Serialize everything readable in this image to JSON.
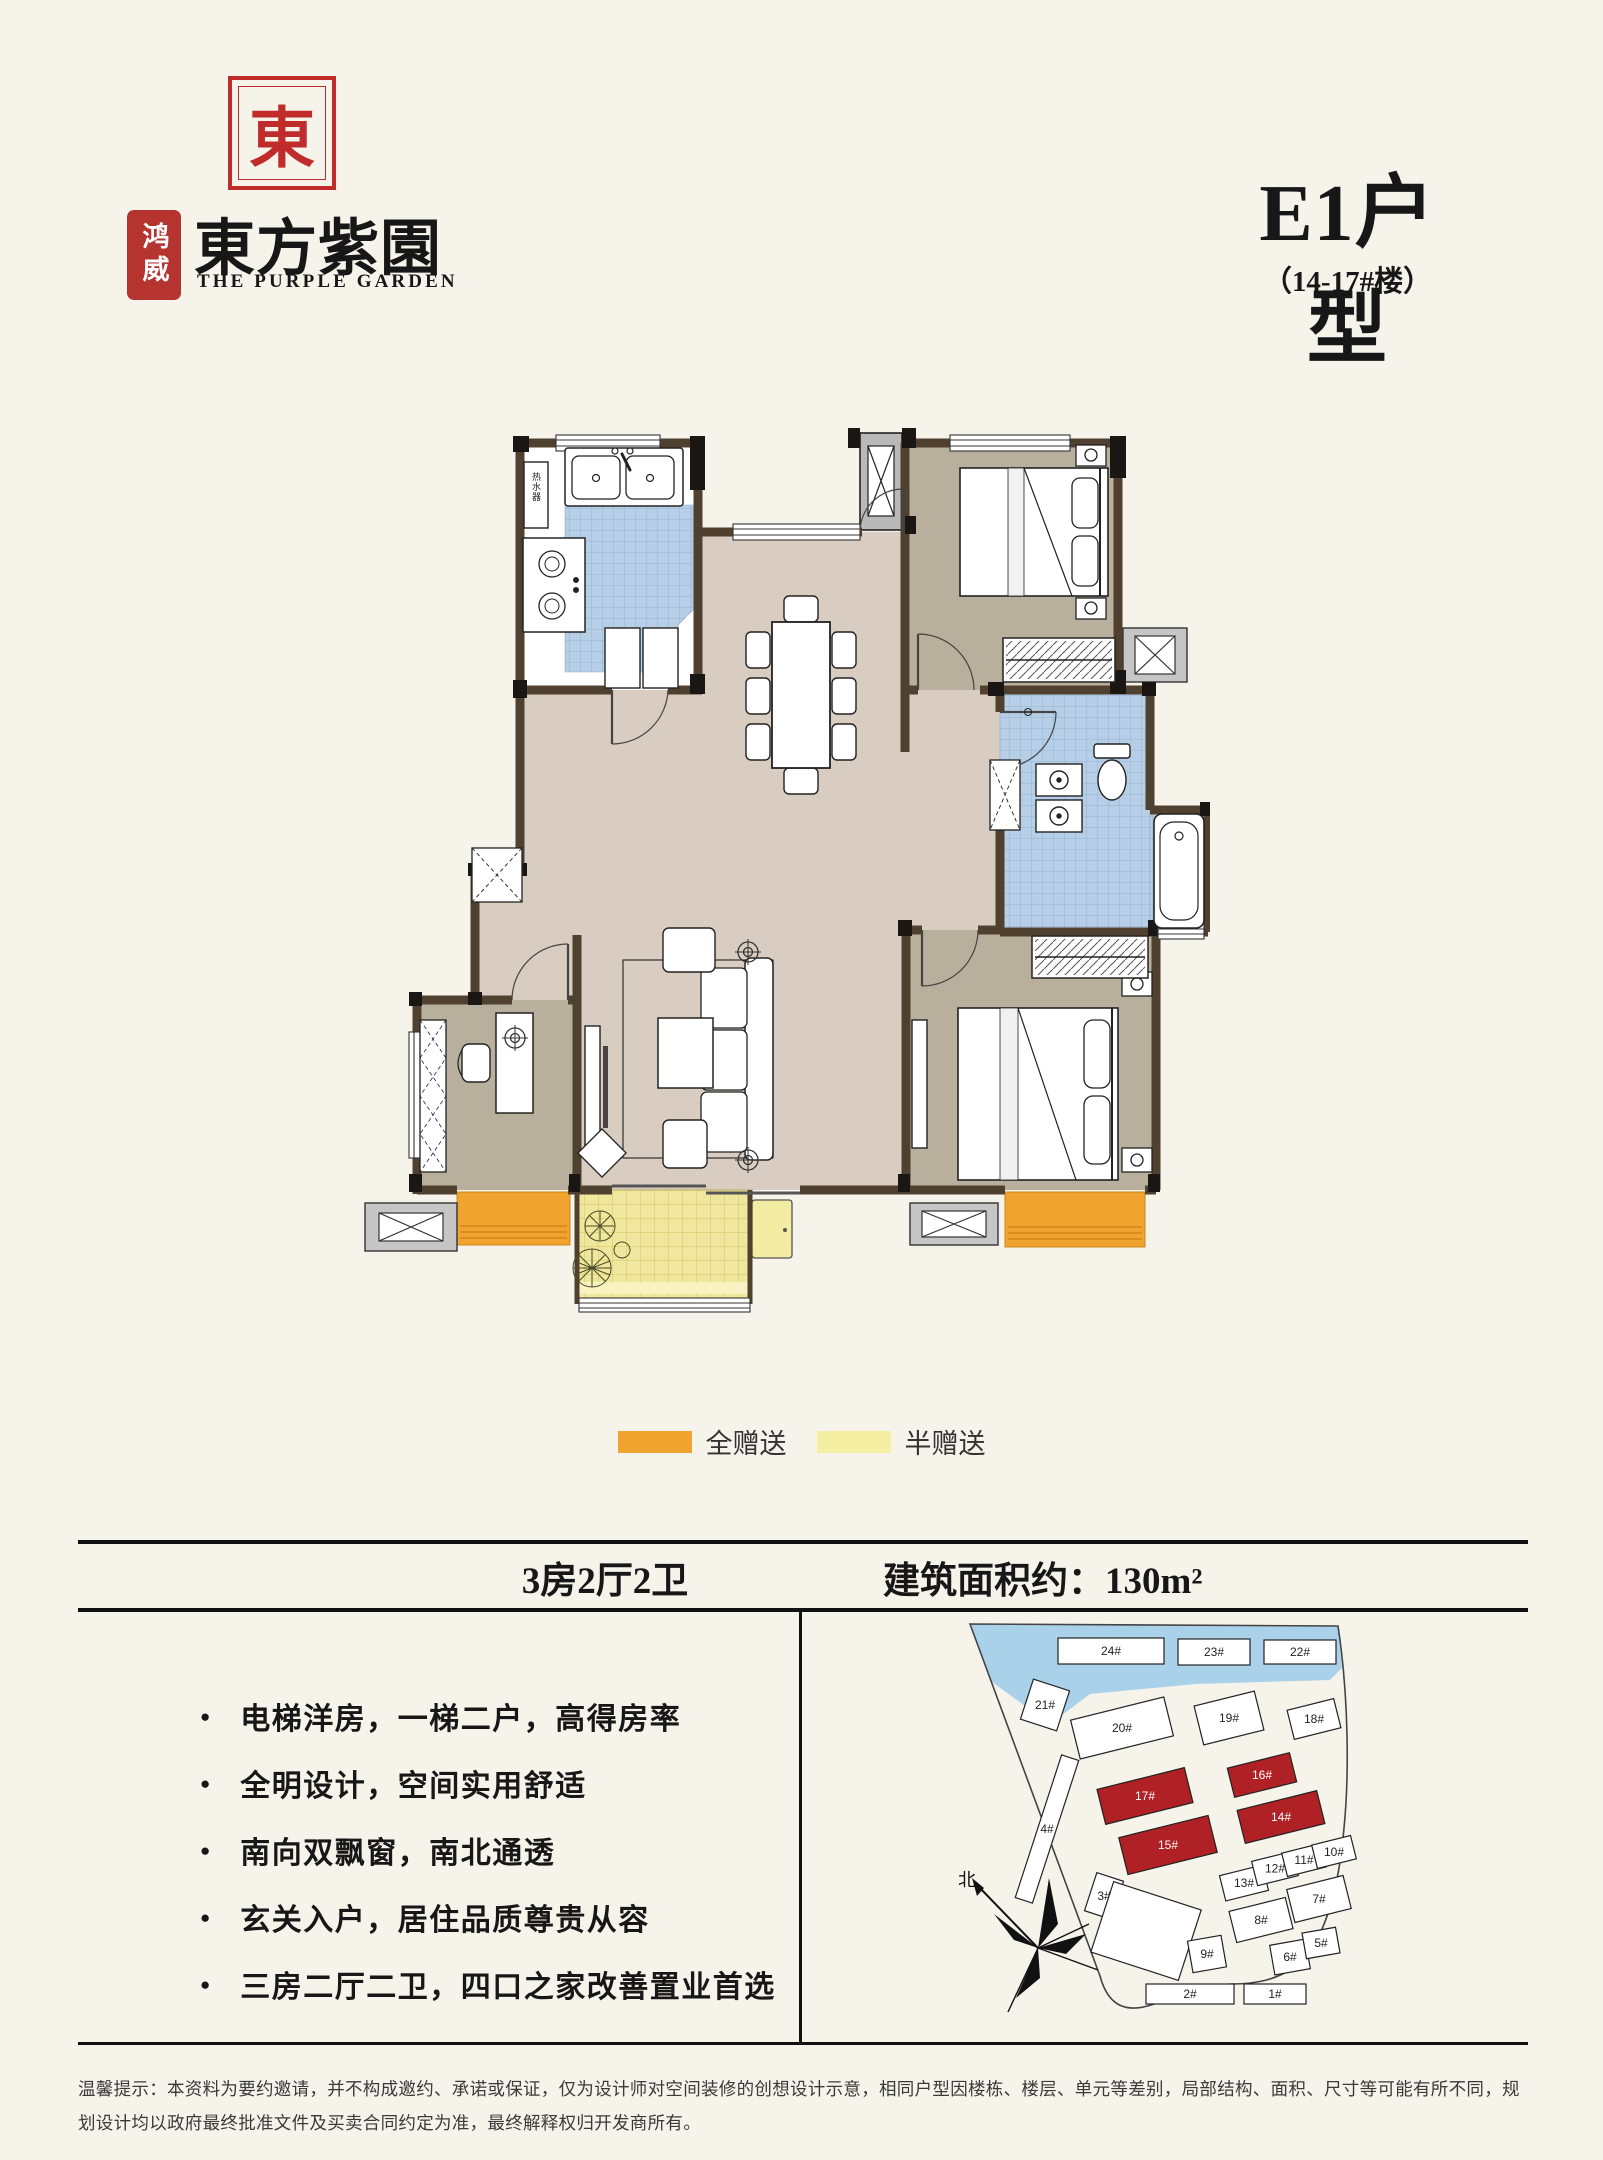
{
  "brand": {
    "seal_glyph": "東",
    "sub_seal": "鸿威",
    "name_cn": "東方紫園",
    "name_en": "THE PURPLE GARDEN"
  },
  "header": {
    "unit_title": "E1户型",
    "unit_subtitle": "（14-17#楼）"
  },
  "floor_plan": {
    "water_heater_label": "热水器"
  },
  "legend": {
    "items": [
      {
        "label": "全赠送",
        "color": "#f0a32e"
      },
      {
        "label": "半赠送",
        "color": "#f5efa4"
      }
    ]
  },
  "info_bar": {
    "layout": "3房2厅2卫",
    "area": "建筑面积约：130m²"
  },
  "features": [
    "电梯洋房，一梯二户，高得房率",
    "全明设计，空间实用舒适",
    "南向双飘窗，南北通透",
    "玄关入户，居住品质尊贵从容",
    "三房二厅二卫，四口之家改善置业首选"
  ],
  "site_map": {
    "north_label": "北",
    "highlight_color": "#b02125",
    "water_color": "#a9d1ea",
    "buildings": [
      {
        "label": "24#",
        "x": 108,
        "y": 20,
        "w": 106,
        "h": 26,
        "r": 0
      },
      {
        "label": "23#",
        "x": 228,
        "y": 21,
        "w": 72,
        "h": 26,
        "r": 0
      },
      {
        "label": "22#",
        "x": 314,
        "y": 22,
        "w": 72,
        "h": 24,
        "r": 0
      },
      {
        "label": "21#",
        "x": 76,
        "y": 66,
        "w": 38,
        "h": 42,
        "r": 18
      },
      {
        "label": "20#",
        "x": 124,
        "y": 90,
        "w": 96,
        "h": 40,
        "r": -14
      },
      {
        "label": "19#",
        "x": 248,
        "y": 80,
        "w": 62,
        "h": 40,
        "r": -14
      },
      {
        "label": "18#",
        "x": 340,
        "y": 86,
        "w": 48,
        "h": 30,
        "r": -14
      },
      {
        "label": "4#",
        "x": 88,
        "y": 136,
        "w": 18,
        "h": 150,
        "r": 18
      },
      {
        "label": "17#",
        "x": 150,
        "y": 160,
        "w": 90,
        "h": 36,
        "r": -14,
        "hl": true
      },
      {
        "label": "16#",
        "x": 280,
        "y": 142,
        "w": 64,
        "h": 30,
        "r": -14,
        "hl": true
      },
      {
        "label": "15#",
        "x": 172,
        "y": 208,
        "w": 92,
        "h": 38,
        "r": -14,
        "hl": true
      },
      {
        "label": "14#",
        "x": 290,
        "y": 182,
        "w": 82,
        "h": 34,
        "r": -14,
        "hl": true
      },
      {
        "label": "3#",
        "x": 140,
        "y": 258,
        "w": 28,
        "h": 40,
        "r": 18
      },
      {
        "label": "",
        "x": 150,
        "y": 276,
        "w": 92,
        "h": 74,
        "r": 18
      },
      {
        "label": "13#",
        "x": 272,
        "y": 252,
        "w": 44,
        "h": 26,
        "r": -14
      },
      {
        "label": "12#",
        "x": 304,
        "y": 238,
        "w": 42,
        "h": 25,
        "r": -14
      },
      {
        "label": "11#",
        "x": 334,
        "y": 230,
        "w": 40,
        "h": 24,
        "r": -14
      },
      {
        "label": "10#",
        "x": 364,
        "y": 222,
        "w": 40,
        "h": 24,
        "r": -14
      },
      {
        "label": "8#",
        "x": 282,
        "y": 286,
        "w": 58,
        "h": 32,
        "r": -14
      },
      {
        "label": "7#",
        "x": 340,
        "y": 264,
        "w": 58,
        "h": 34,
        "r": -14
      },
      {
        "label": "9#",
        "x": 240,
        "y": 320,
        "w": 34,
        "h": 32,
        "r": -10
      },
      {
        "label": "6#",
        "x": 322,
        "y": 324,
        "w": 36,
        "h": 30,
        "r": -10
      },
      {
        "label": "5#",
        "x": 354,
        "y": 312,
        "w": 34,
        "h": 26,
        "r": -10
      },
      {
        "label": "2#",
        "x": 196,
        "y": 366,
        "w": 88,
        "h": 20,
        "r": 0
      },
      {
        "label": "1#",
        "x": 294,
        "y": 366,
        "w": 62,
        "h": 20,
        "r": 0
      }
    ]
  },
  "footer": {
    "disclaimer": "温馨提示：本资料为要约邀请，并不构成邀约、承诺或保证，仅为设计师对空间装修的创想设计示意，相同户型因楼栋、楼层、单元等差别，局部结构、面积、尺寸等可能有所不同，规划设计均以政府最终批准文件及买卖合同约定为准，最终解释权归开发商所有。"
  }
}
